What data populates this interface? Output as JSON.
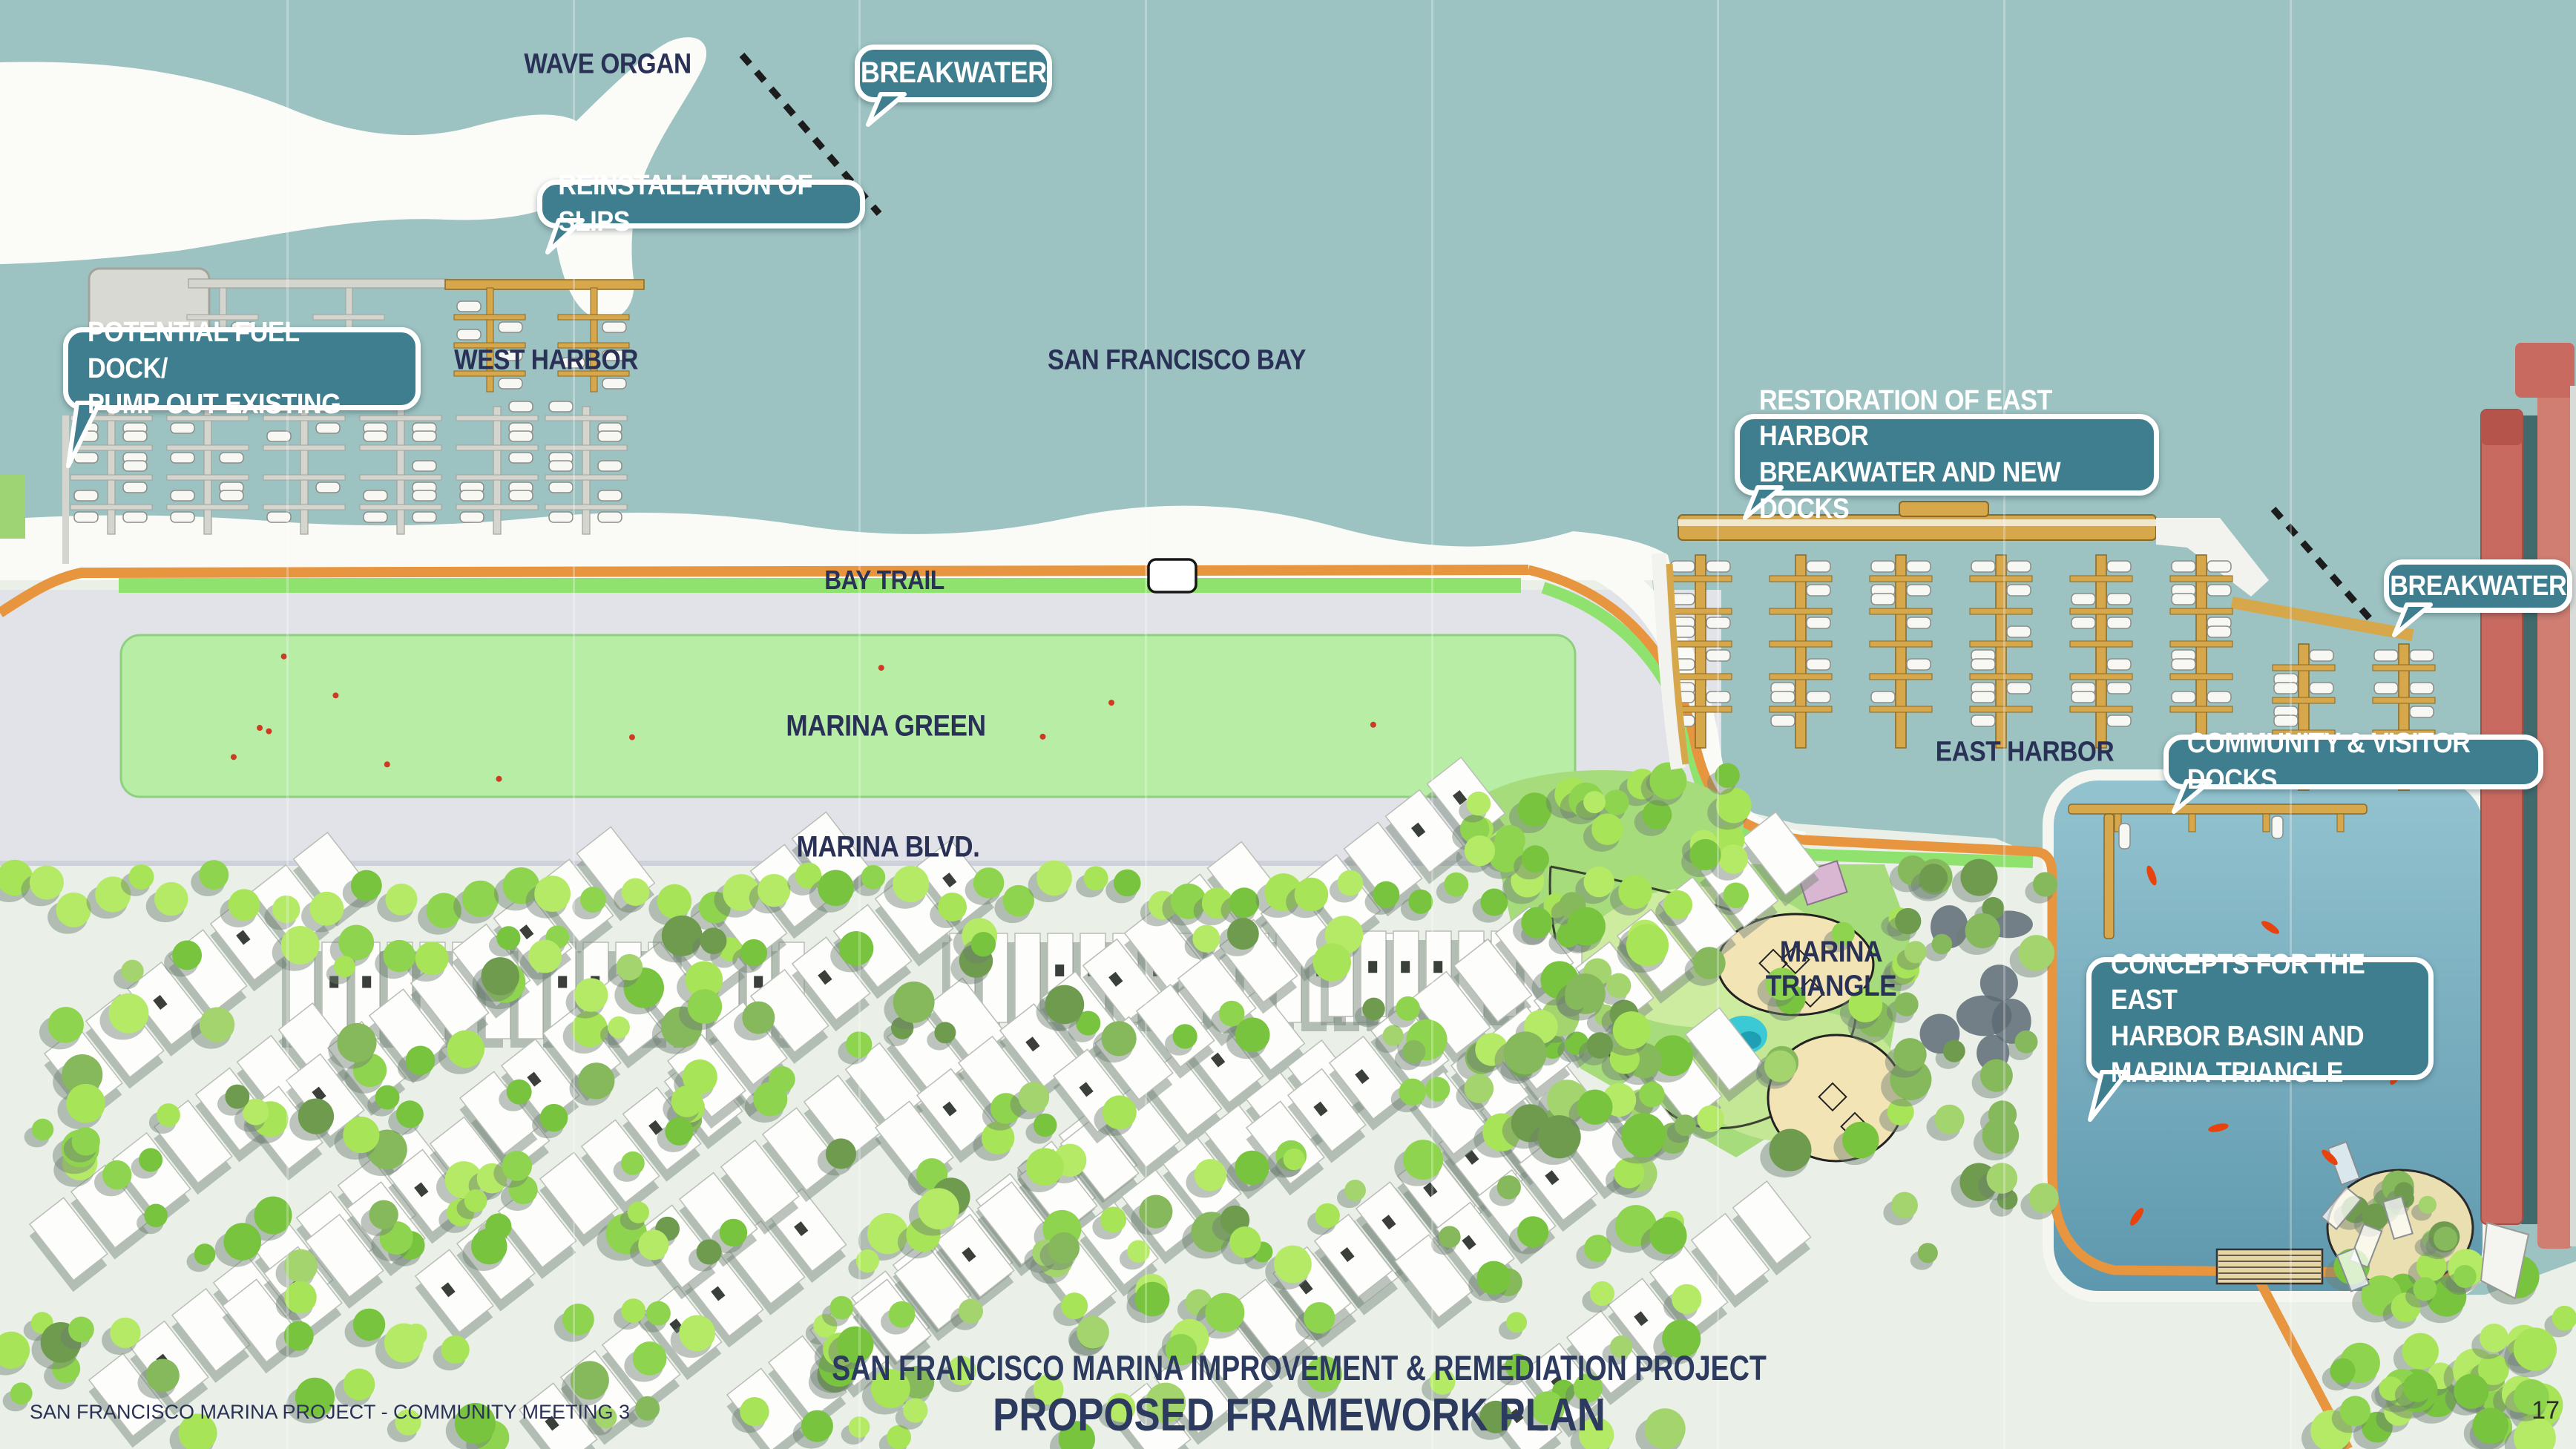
{
  "slide": {
    "footer_left": "SAN FRANCISCO MARINA PROJECT - COMMUNITY MEETING 3",
    "page_number": "17",
    "title_line1": "SAN FRANCISCO MARINA IMPROVEMENT & REMEDIATION PROJECT",
    "title_line2": "PROPOSED FRAMEWORK PLAN"
  },
  "map_labels": {
    "wave_organ": "WAVE ORGAN",
    "west_harbor": "WEST HARBOR",
    "san_francisco_bay": "SAN FRANCISCO BAY",
    "bay_trail": "BAY TRAIL",
    "marina_green": "MARINA GREEN",
    "east_harbor": "EAST HARBOR",
    "marina_blvd": "MARINA BLVD.",
    "marina_triangle": "MARINA TRIANGLE"
  },
  "callouts": {
    "breakwater_west": "BREAKWATER",
    "reinstallation_of_slips": "REINSTALLATION OF SLIPS",
    "potential_fuel_dock": "POTENTIAL FUEL DOCK/\nPUMP OUT EXISTING",
    "restoration_east_harbor": "RESTORATION OF EAST HARBOR\nBREAKWATER AND NEW DOCKS",
    "breakwater_east": "BREAKWATER",
    "community_visitor_docks": "COMMUNITY & VISITOR DOCKS",
    "concepts_east_harbor": "CONCEPTS FOR THE EAST\nHARBOR BASIN AND\nMARINA TRIANGLE"
  },
  "colors": {
    "water": "#9cc2c1",
    "basin_water_top": "#93c3cf",
    "basin_water_bottom": "#5e98ae",
    "callout": "#3f7e8f",
    "label_text": "#2a3156",
    "title_text": "#2b3a5e",
    "lawn": "#b8eda6",
    "trail_orange": "#e8953f",
    "trail_green": "#90e26e",
    "dock_gold": "#d7a74b",
    "dock_gray": "#d4d5cf",
    "pier_red": "#c96a60",
    "city_base": "#eaf0e8",
    "tree_green": "#a8e457",
    "marker_red": "#e8430e"
  }
}
